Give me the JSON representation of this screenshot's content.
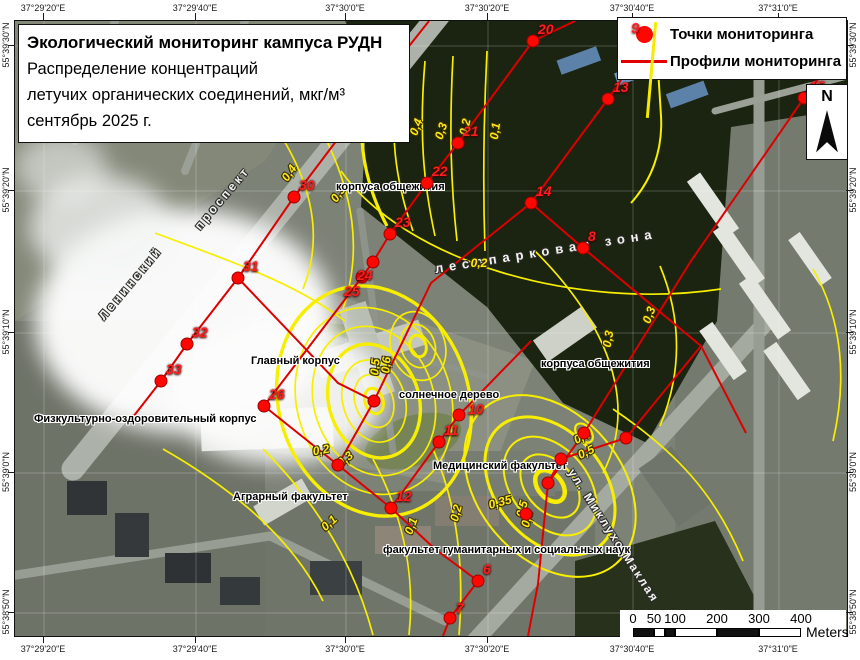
{
  "title_box": {
    "line1": "Экологический мониторинг кампуса РУДН",
    "line2": "Распределение концентраций",
    "line3": "летучих органических соединений, мкг/м³",
    "line4": "сентябрь 2025 г."
  },
  "legend": {
    "point_number": "9",
    "point_item": "Точки мониторинга",
    "profile_item": "Профили мониторинга"
  },
  "north": {
    "label": "N"
  },
  "scale_bar": {
    "ticks": [
      "0",
      "50",
      "100",
      "200",
      "300",
      "400"
    ],
    "unit": "Meters"
  },
  "graticule": {
    "top": [
      {
        "label": "37°29'20\"E",
        "x": 43
      },
      {
        "label": "37°29'40\"E",
        "x": 195
      },
      {
        "label": "37°30'0\"E",
        "x": 345
      },
      {
        "label": "37°30'20\"E",
        "x": 487
      },
      {
        "label": "37°30'40\"E",
        "x": 632
      },
      {
        "label": "37°31'0\"E",
        "x": 778
      }
    ],
    "bottom": [
      {
        "label": "37°29'20\"E",
        "x": 43
      },
      {
        "label": "37°29'40\"E",
        "x": 195
      },
      {
        "label": "37°30'0\"E",
        "x": 345
      },
      {
        "label": "37°30'20\"E",
        "x": 487
      },
      {
        "label": "37°30'40\"E",
        "x": 632
      },
      {
        "label": "37°31'0\"E",
        "x": 778
      }
    ],
    "left": [
      {
        "label": "55°39'30\"N",
        "y": 45
      },
      {
        "label": "55°39'20\"N",
        "y": 190
      },
      {
        "label": "55°39'10\"N",
        "y": 332
      },
      {
        "label": "55°39'0\"N",
        "y": 472
      },
      {
        "label": "55°38'50\"N",
        "y": 612
      }
    ],
    "right": [
      {
        "label": "55°39'30\"N",
        "y": 45
      },
      {
        "label": "55°39'20\"N",
        "y": 190
      },
      {
        "label": "55°39'10\"N",
        "y": 332
      },
      {
        "label": "55°39'0\"N",
        "y": 472
      },
      {
        "label": "55°38'50\"N",
        "y": 612
      }
    ]
  },
  "map": {
    "place_labels": [
      {
        "text": "корпуса общежития",
        "x": 321,
        "y": 160
      },
      {
        "text": "Главный корпус",
        "x": 236,
        "y": 334
      },
      {
        "text": "солнечное дерево",
        "x": 384,
        "y": 368
      },
      {
        "text": "корпуса общежития",
        "x": 526,
        "y": 337
      },
      {
        "text": "Медицинский факультет",
        "x": 418,
        "y": 439
      },
      {
        "text": "Аграрный факультет",
        "x": 218,
        "y": 470
      },
      {
        "text": "Физкультурно-оздоровительный корпус",
        "x": 19,
        "y": 392
      },
      {
        "text": "факультет гуманитарных и социальных наук",
        "x": 368,
        "y": 523
      }
    ],
    "street_labels": [
      {
        "text": "Ленинский",
        "x": 86,
        "y": 290,
        "rot": -50,
        "ls": 3,
        "fs": 12
      },
      {
        "text": "проспект",
        "x": 182,
        "y": 200,
        "rot": -50,
        "ls": 3,
        "fs": 12
      },
      {
        "text": "лесопарковая зона",
        "x": 420,
        "y": 240,
        "rot": -9,
        "ls": 6,
        "fs": 13
      },
      {
        "text": "ул. Миклухо-Маклая",
        "x": 556,
        "y": 442,
        "rot": 57,
        "ls": 2,
        "fs": 12
      }
    ],
    "contour_labels": [
      {
        "text": "0,5",
        "x": 376,
        "y": 98,
        "rot": -65
      },
      {
        "text": "0,4",
        "x": 401,
        "y": 106,
        "rot": -70
      },
      {
        "text": "0,3",
        "x": 426,
        "y": 110,
        "rot": -72
      },
      {
        "text": "0,2",
        "x": 450,
        "y": 106,
        "rot": -78
      },
      {
        "text": "0,1",
        "x": 480,
        "y": 110,
        "rot": -82
      },
      {
        "text": "0,4",
        "x": 274,
        "y": 152,
        "rot": -55
      },
      {
        "text": "0,3",
        "x": 323,
        "y": 173,
        "rot": -55
      },
      {
        "text": "0,2",
        "x": 464,
        "y": 242,
        "rot": 0
      },
      {
        "text": "0,3",
        "x": 593,
        "y": 318,
        "rot": -80
      },
      {
        "text": "0,3",
        "x": 634,
        "y": 294,
        "rot": -70
      },
      {
        "text": "0,2",
        "x": 306,
        "y": 429,
        "rot": -10
      },
      {
        "text": "0,3",
        "x": 330,
        "y": 438,
        "rot": -40
      },
      {
        "text": "0,1",
        "x": 314,
        "y": 502,
        "rot": -42
      },
      {
        "text": "0,1",
        "x": 396,
        "y": 505,
        "rot": -70
      },
      {
        "text": "0,2",
        "x": 441,
        "y": 492,
        "rot": -75
      },
      {
        "text": "0,35",
        "x": 485,
        "y": 481,
        "rot": -15
      },
      {
        "text": "0,5",
        "x": 507,
        "y": 488,
        "rot": -75
      },
      {
        "text": "0,6",
        "x": 512,
        "y": 498,
        "rot": -75
      },
      {
        "text": "0,4",
        "x": 567,
        "y": 416,
        "rot": -25
      },
      {
        "text": "0,5",
        "x": 571,
        "y": 431,
        "rot": -25
      },
      {
        "text": "0,5",
        "x": 360,
        "y": 346,
        "rot": -85
      },
      {
        "text": "0,6",
        "x": 371,
        "y": 344,
        "rot": -85
      }
    ],
    "points": [
      {
        "n": "15",
        "x": 789,
        "y": 77
      },
      {
        "n": "13",
        "x": 593,
        "y": 78
      },
      {
        "n": "20",
        "x": 518,
        "y": 20
      },
      {
        "n": "21",
        "x": 443,
        "y": 122
      },
      {
        "n": "22",
        "x": 412,
        "y": 162
      },
      {
        "n": "23",
        "x": 375,
        "y": 213
      },
      {
        "n": "24",
        "x": 358,
        "y": 241,
        "lx": -16,
        "ly": 5
      },
      {
        "n": "25",
        "x": 347,
        "y": 256,
        "lx": -18,
        "ly": 6
      },
      {
        "n": "26",
        "x": 249,
        "y": 385
      },
      {
        "n": "29",
        "x": 368,
        "y": 58
      },
      {
        "n": "30",
        "x": 279,
        "y": 176
      },
      {
        "n": "31",
        "x": 223,
        "y": 257
      },
      {
        "n": "32",
        "x": 172,
        "y": 323
      },
      {
        "n": "33",
        "x": 146,
        "y": 360
      },
      {
        "n": "14",
        "x": 516,
        "y": 182
      },
      {
        "n": "8",
        "x": 568,
        "y": 227
      },
      {
        "n": "10",
        "x": 444,
        "y": 394,
        "lx": 9,
        "ly": -14
      },
      {
        "n": "11",
        "x": 424,
        "y": 421
      },
      {
        "n": "12",
        "x": 376,
        "y": 487
      },
      {
        "n": "6",
        "x": 463,
        "y": 560
      },
      {
        "n": "7",
        "x": 435,
        "y": 597,
        "lx": 6,
        "ly": -18
      },
      {
        "n": "",
        "x": 323,
        "y": 444
      },
      {
        "n": "",
        "x": 569,
        "y": 412
      },
      {
        "n": "",
        "x": 533,
        "y": 462
      },
      {
        "n": "",
        "x": 611,
        "y": 417
      },
      {
        "n": "",
        "x": 511,
        "y": 493
      },
      {
        "n": "",
        "x": 359,
        "y": 380
      },
      {
        "n": "",
        "x": 546,
        "y": 438
      }
    ],
    "profiles": [
      [
        [
          560,
          0
        ],
        [
          518,
          20
        ],
        [
          443,
          122
        ],
        [
          412,
          162
        ],
        [
          375,
          213
        ],
        [
          358,
          241
        ],
        [
          347,
          256
        ],
        [
          249,
          385
        ],
        [
          323,
          444
        ],
        [
          376,
          487
        ],
        [
          420,
          528
        ],
        [
          463,
          560
        ],
        [
          435,
          597
        ],
        [
          428,
          615
        ]
      ],
      [
        [
          414,
          0
        ],
        [
          368,
          58
        ],
        [
          279,
          176
        ],
        [
          223,
          257
        ],
        [
          172,
          323
        ],
        [
          146,
          360
        ],
        [
          118,
          396
        ]
      ],
      [
        [
          646,
          0
        ],
        [
          593,
          78
        ],
        [
          516,
          182
        ],
        [
          416,
          262
        ],
        [
          359,
          380
        ],
        [
          323,
          444
        ]
      ],
      [
        [
          223,
          257
        ],
        [
          323,
          362
        ],
        [
          359,
          380
        ]
      ],
      [
        [
          516,
          182
        ],
        [
          568,
          227
        ],
        [
          686,
          325
        ],
        [
          731,
          412
        ]
      ],
      [
        [
          832,
          20
        ],
        [
          789,
          77
        ],
        [
          676,
          240
        ],
        [
          569,
          412
        ],
        [
          533,
          462
        ],
        [
          523,
          563
        ],
        [
          513,
          615
        ]
      ],
      [
        [
          516,
          320
        ],
        [
          444,
          394
        ],
        [
          424,
          421
        ],
        [
          376,
          487
        ]
      ],
      [
        [
          686,
          325
        ],
        [
          611,
          417
        ],
        [
          546,
          438
        ],
        [
          533,
          462
        ]
      ]
    ]
  },
  "colors": {
    "contour": "#f7ee00",
    "point": "#ff0600",
    "profile": "#dc0000"
  }
}
